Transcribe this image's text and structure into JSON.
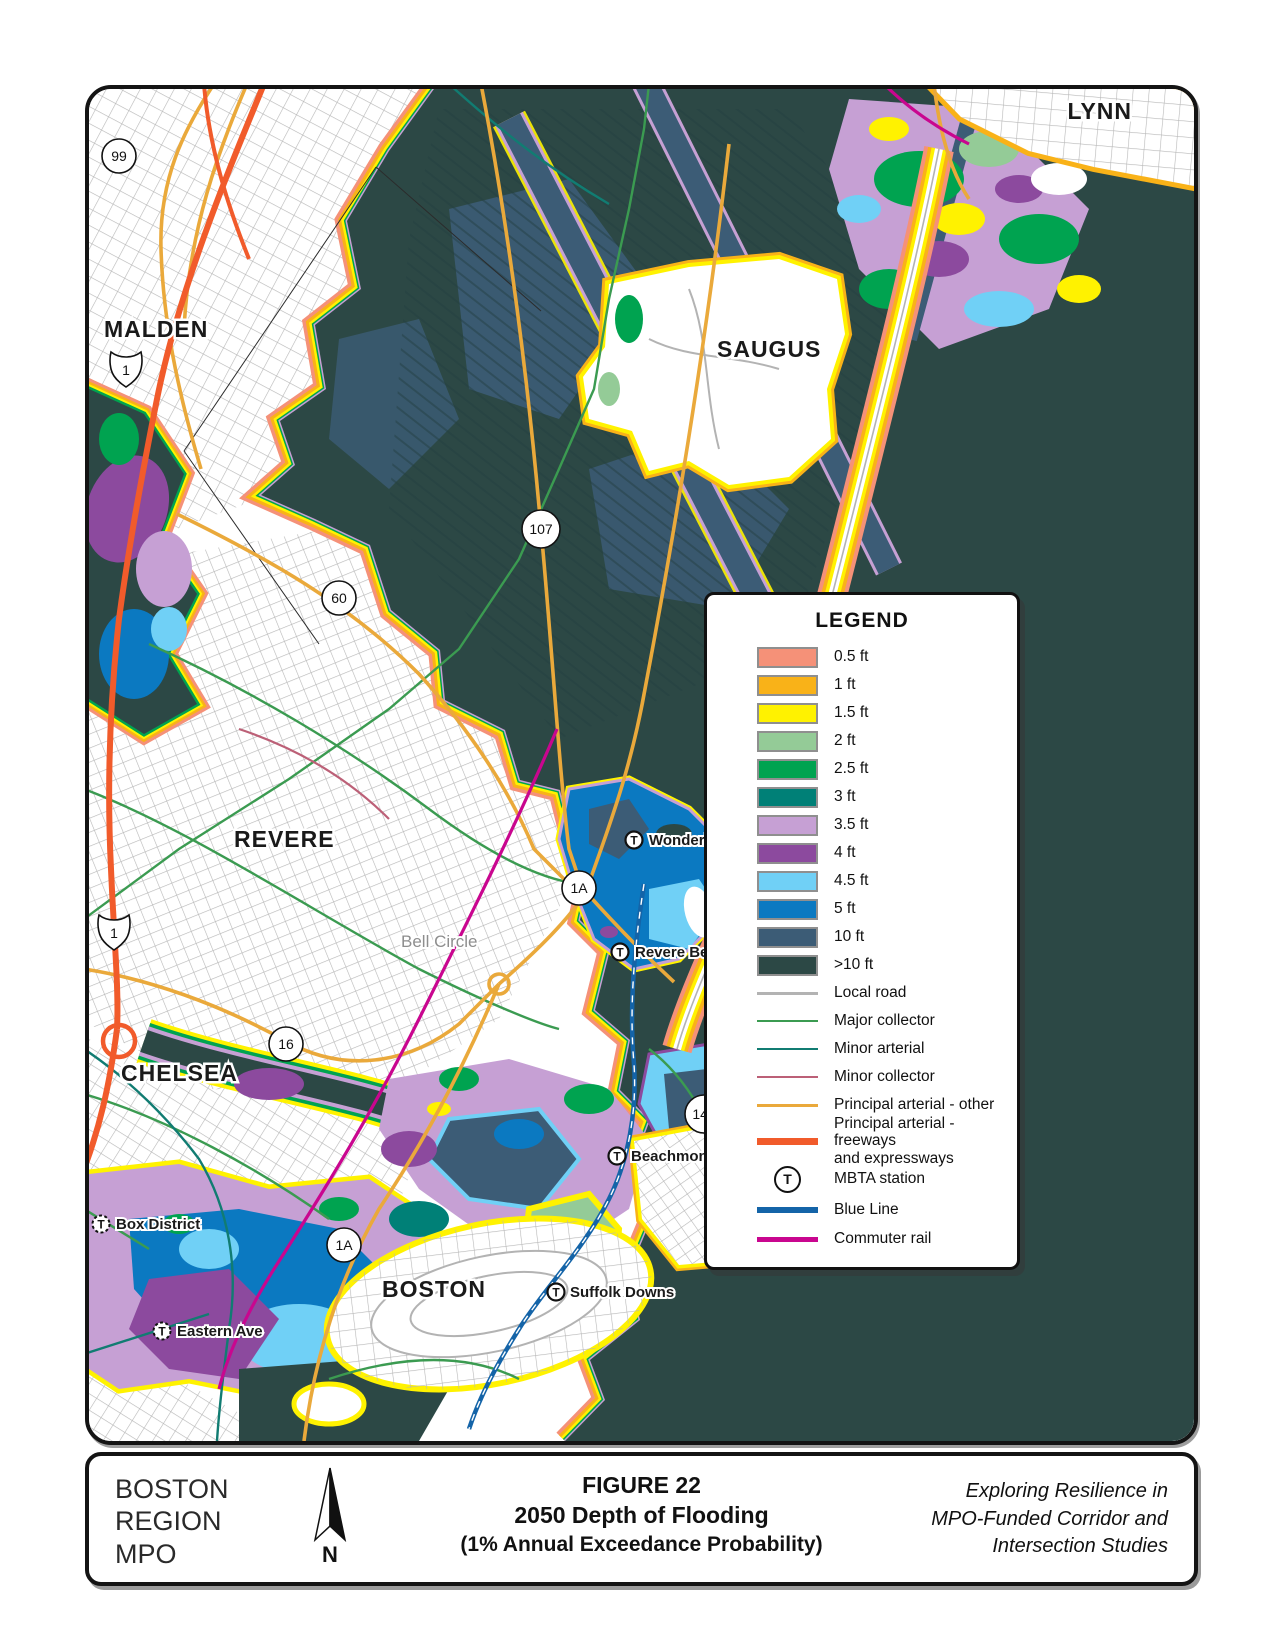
{
  "map": {
    "cities": {
      "lynn": "LYNN",
      "malden": "MALDEN",
      "saugus": "SAUGUS",
      "revere": "REVERE",
      "chelsea": "CHELSEA",
      "boston": "BOSTON"
    },
    "places": {
      "wonderland": "Wonderland",
      "revere_beach": "Revere Beach",
      "beachmont": "Beachmont",
      "box_district": "Box District",
      "suffolk_downs": "Suffolk Downs",
      "eastern_ave": "Eastern Ave",
      "bell_circle": "Bell Circle"
    },
    "shields": {
      "r99": "99",
      "r1": "1",
      "r107": "107",
      "r60": "60",
      "r1a": "1A",
      "r16": "16",
      "r145": "145"
    },
    "t_glyph": "T"
  },
  "legend": {
    "title": "LEGEND",
    "depths": [
      {
        "label": "0.5 ft",
        "color": "#F59178"
      },
      {
        "label": "1 ft",
        "color": "#F9B218"
      },
      {
        "label": "1.5 ft",
        "color": "#FFF200"
      },
      {
        "label": "2 ft",
        "color": "#94CB97"
      },
      {
        "label": "2.5 ft",
        "color": "#00A350"
      },
      {
        "label": "3 ft",
        "color": "#008077"
      },
      {
        "label": "3.5 ft",
        "color": "#C6A0D4"
      },
      {
        "label": "4 ft",
        "color": "#8C4A9E"
      },
      {
        "label": "4.5 ft",
        "color": "#70D0F6"
      },
      {
        "label": "5 ft",
        "color": "#0B79C1"
      },
      {
        "label": "10 ft",
        "color": "#3C5C76"
      },
      {
        "label": ">10 ft",
        "color": "#2C4845"
      }
    ],
    "roads": [
      {
        "label": "Local road",
        "color": "#B3B3B3"
      },
      {
        "label": "Major collector",
        "color": "#3B9B51"
      },
      {
        "label": "Minor arterial",
        "color": "#117C72"
      },
      {
        "label": "Minor collector",
        "color": "#BC6077"
      },
      {
        "label": "Principal arterial - other",
        "color": "#EAA93B"
      }
    ],
    "freeway": {
      "line1": "Principal arterial - freeways",
      "line2": "and expressways",
      "color": "#F15B2B"
    },
    "mbta_label": "MBTA station",
    "blue_line": {
      "label": "Blue Line",
      "color": "#1464A8"
    },
    "commuter_rail": {
      "label": "Commuter rail",
      "color": "#C9068F"
    }
  },
  "footer": {
    "org_line1": "BOSTON",
    "org_line2": "REGION",
    "org_line3": "MPO",
    "figure_label": "FIGURE 22",
    "title": "2050 Depth of Flooding",
    "subtitle": "(1% Annual Exceedance Probability)",
    "right_line1": "Exploring Resilience in",
    "right_line2": "MPO-Funded Corridor and",
    "right_line3": "Intersection Studies",
    "north_label": "N"
  }
}
